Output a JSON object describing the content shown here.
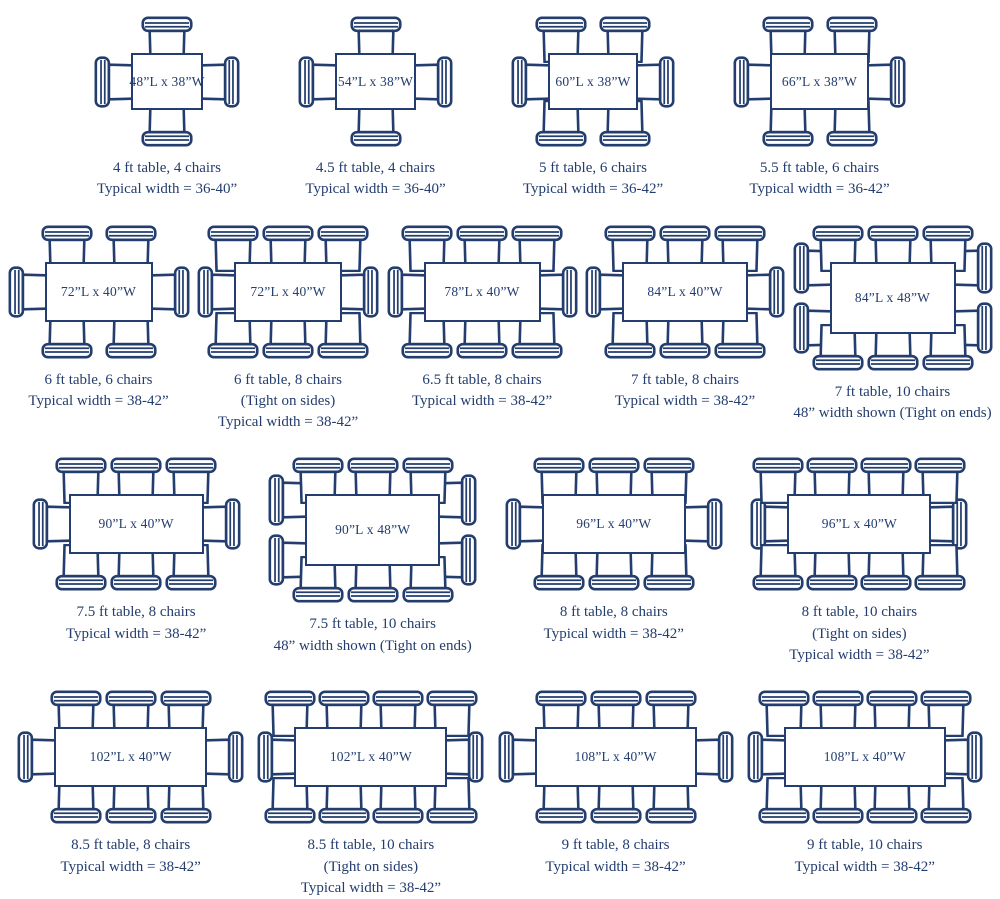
{
  "page": {
    "title": "Dining table sizes and seating diagram",
    "accent_color": "#233D6E",
    "background_color": "#ffffff"
  },
  "rows": [
    {
      "figures": [
        {
          "label": "48”L x 38”W",
          "length_in": 48,
          "width_in": 38,
          "chairs": {
            "top": 1,
            "bottom": 1,
            "left": 1,
            "right": 1
          },
          "caption": [
            "4 ft table, 4 chairs",
            "Typical width = 36-40”"
          ]
        },
        {
          "label": "54”L x 38”W",
          "length_in": 54,
          "width_in": 38,
          "chairs": {
            "top": 1,
            "bottom": 1,
            "left": 1,
            "right": 1
          },
          "caption": [
            "4.5 ft table, 4 chairs",
            "Typical width = 36-40”"
          ]
        },
        {
          "label": "60”L x 38”W",
          "length_in": 60,
          "width_in": 38,
          "chairs": {
            "top": 2,
            "bottom": 2,
            "left": 1,
            "right": 1
          },
          "caption": [
            "5 ft table, 6 chairs",
            "Typical width = 36-42”"
          ]
        },
        {
          "label": "66”L x 38”W",
          "length_in": 66,
          "width_in": 38,
          "chairs": {
            "top": 2,
            "bottom": 2,
            "left": 1,
            "right": 1
          },
          "caption": [
            "5.5 ft table, 6 chairs",
            "Typical width = 36-42”"
          ]
        }
      ]
    },
    {
      "figures": [
        {
          "label": "72”L x 40”W",
          "length_in": 72,
          "width_in": 40,
          "chairs": {
            "top": 2,
            "bottom": 2,
            "left": 1,
            "right": 1
          },
          "caption": [
            "6 ft table, 6 chairs",
            "Typical width = 38-42”"
          ]
        },
        {
          "label": "72”L x 40”W",
          "length_in": 72,
          "width_in": 40,
          "chairs": {
            "top": 3,
            "bottom": 3,
            "left": 1,
            "right": 1
          },
          "caption": [
            "6 ft table, 8 chairs",
            "(Tight on sides)",
            "Typical width = 38-42”"
          ]
        },
        {
          "label": "78”L x 40”W",
          "length_in": 78,
          "width_in": 40,
          "chairs": {
            "top": 3,
            "bottom": 3,
            "left": 1,
            "right": 1
          },
          "caption": [
            "6.5 ft table, 8 chairs",
            "Typical width = 38-42”"
          ]
        },
        {
          "label": "84”L x 40”W",
          "length_in": 84,
          "width_in": 40,
          "chairs": {
            "top": 3,
            "bottom": 3,
            "left": 1,
            "right": 1
          },
          "caption": [
            "7 ft table, 8 chairs",
            "Typical width = 38-42”"
          ]
        },
        {
          "label": "84”L x 48”W",
          "length_in": 84,
          "width_in": 48,
          "chairs": {
            "top": 3,
            "bottom": 3,
            "left": 2,
            "right": 2
          },
          "caption": [
            "7 ft table, 10 chairs",
            "48” width shown (Tight on ends)"
          ]
        }
      ]
    },
    {
      "figures": [
        {
          "label": "90”L x 40”W",
          "length_in": 90,
          "width_in": 40,
          "chairs": {
            "top": 3,
            "bottom": 3,
            "left": 1,
            "right": 1
          },
          "caption": [
            "7.5 ft table, 8 chairs",
            "Typical width = 38-42”"
          ]
        },
        {
          "label": "90”L x 48”W",
          "length_in": 90,
          "width_in": 48,
          "chairs": {
            "top": 3,
            "bottom": 3,
            "left": 2,
            "right": 2
          },
          "caption": [
            "7.5 ft table, 10 chairs",
            "48” width shown (Tight on ends)"
          ]
        },
        {
          "label": "96”L x 40”W",
          "length_in": 96,
          "width_in": 40,
          "chairs": {
            "top": 3,
            "bottom": 3,
            "left": 1,
            "right": 1
          },
          "caption": [
            "8 ft table, 8 chairs",
            "Typical width = 38-42”"
          ]
        },
        {
          "label": "96”L x 40”W",
          "length_in": 96,
          "width_in": 40,
          "chairs": {
            "top": 4,
            "bottom": 4,
            "left": 1,
            "right": 1
          },
          "caption": [
            "8 ft table, 10 chairs",
            "(Tight on sides)",
            "Typical width = 38-42”"
          ]
        }
      ]
    },
    {
      "figures": [
        {
          "label": "102”L x 40”W",
          "length_in": 102,
          "width_in": 40,
          "chairs": {
            "top": 3,
            "bottom": 3,
            "left": 1,
            "right": 1
          },
          "caption": [
            "8.5 ft table, 8 chairs",
            "Typical width = 38-42”"
          ]
        },
        {
          "label": "102”L x 40”W",
          "length_in": 102,
          "width_in": 40,
          "chairs": {
            "top": 4,
            "bottom": 4,
            "left": 1,
            "right": 1
          },
          "caption": [
            "8.5 ft table, 10 chairs",
            "(Tight on sides)",
            "Typical width = 38-42”"
          ]
        },
        {
          "label": "108”L x 40”W",
          "length_in": 108,
          "width_in": 40,
          "chairs": {
            "top": 3,
            "bottom": 3,
            "left": 1,
            "right": 1
          },
          "caption": [
            "9 ft table, 8 chairs",
            "Typical width = 38-42”"
          ]
        },
        {
          "label": "108”L x 40”W",
          "length_in": 108,
          "width_in": 40,
          "chairs": {
            "top": 4,
            "bottom": 4,
            "left": 1,
            "right": 1
          },
          "caption": [
            "9 ft table, 10 chairs",
            "Typical width = 38-42”"
          ]
        }
      ]
    }
  ]
}
